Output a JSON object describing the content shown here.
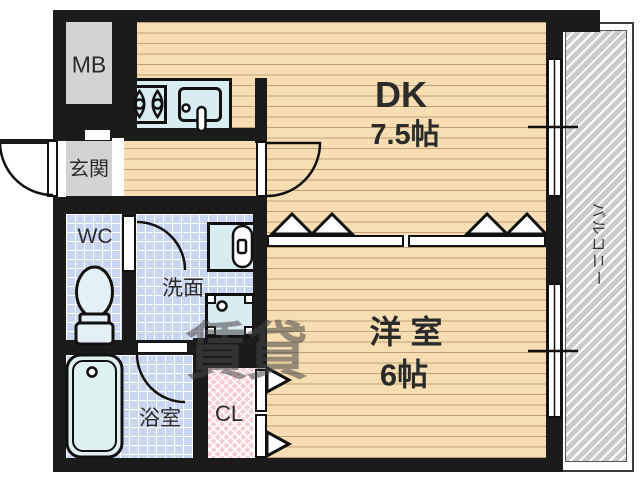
{
  "rooms": {
    "meter_box": "MB",
    "entrance": "玄関",
    "dining_kitchen": "DK",
    "dining_kitchen_size": "7.5帖",
    "western_room": "洋 室",
    "western_room_size": "6帖",
    "toilet": "WC",
    "washroom": "洗面",
    "bathroom": "浴室",
    "closet": "CL",
    "balcony": "バルコニー"
  },
  "watermark": "賃貸",
  "colors": {
    "wall": "#1b1b1b",
    "wood_floor": "#f7ddb2",
    "tile_floor": "#c9d6f0",
    "gray_area": "#d3d3d3",
    "pink_hatch": "#f6cdd2",
    "balcony_hatch": "#cbcbcb",
    "fixture_fill": "#d9ecf1"
  }
}
